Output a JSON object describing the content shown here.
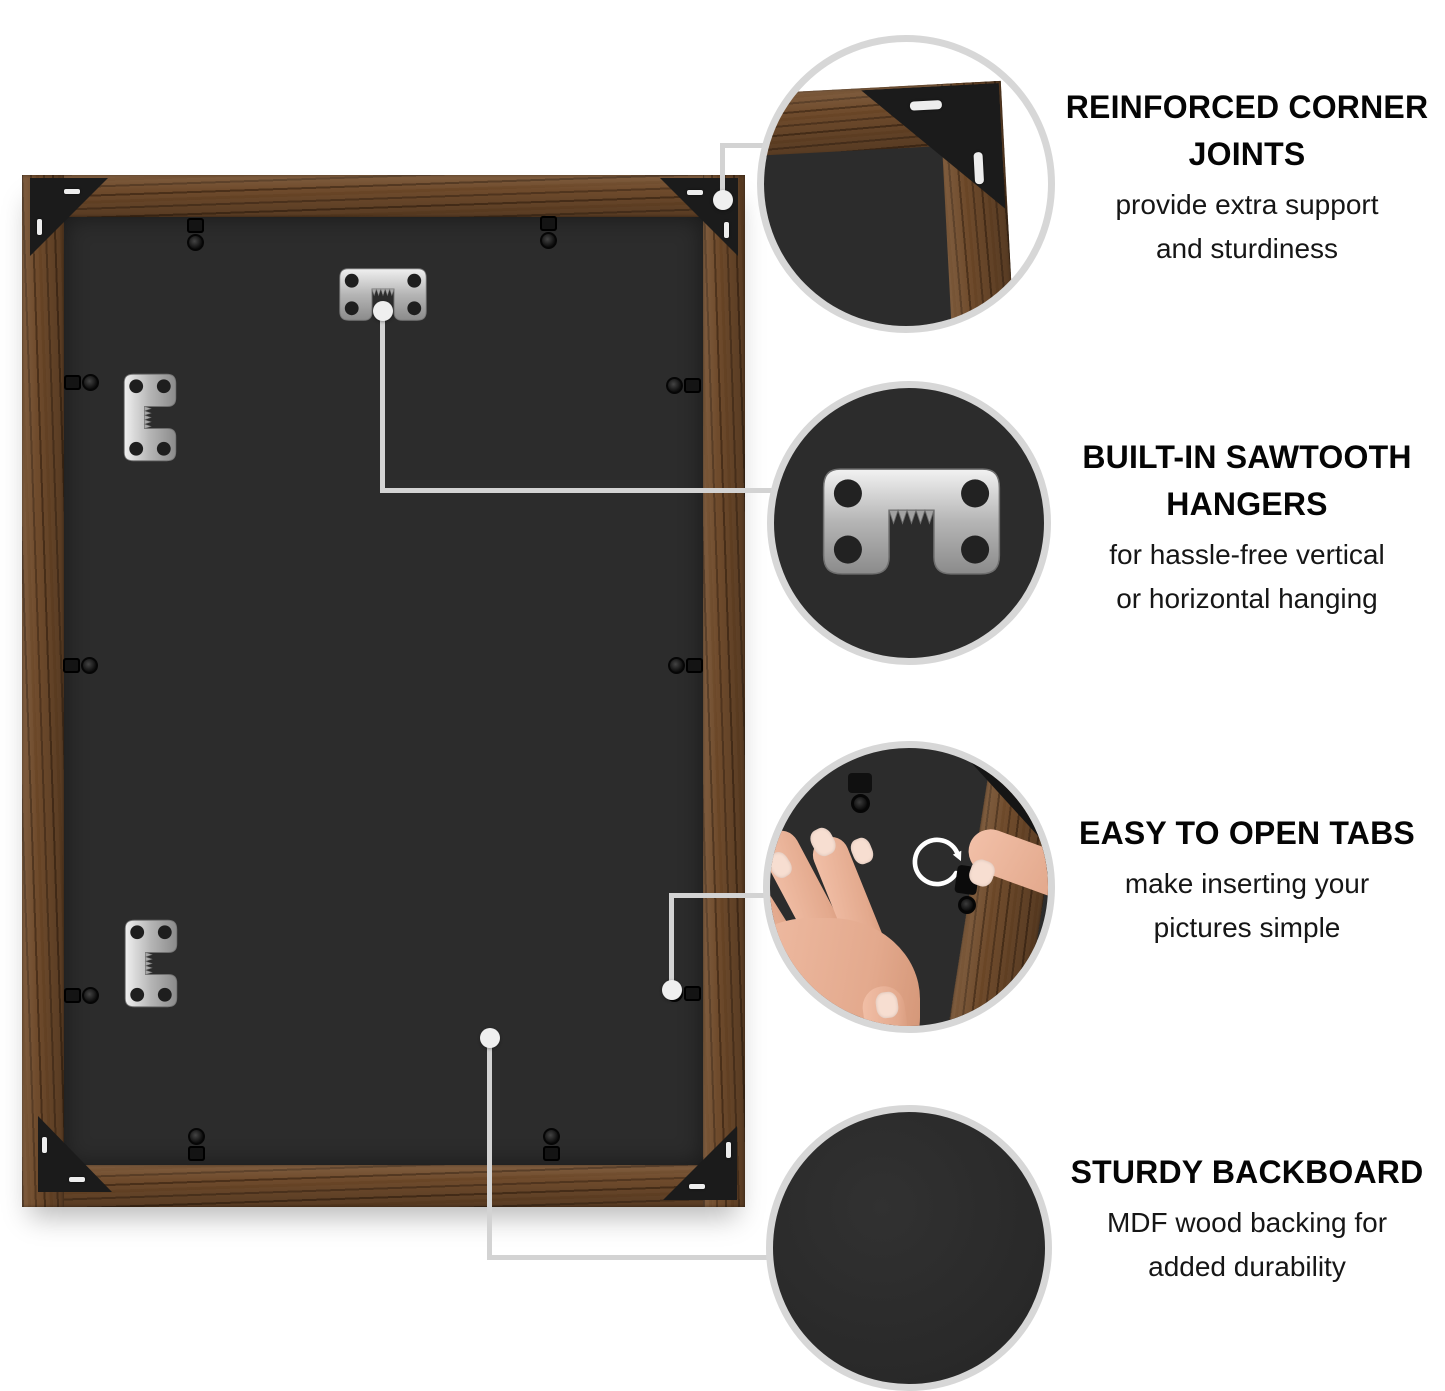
{
  "page_background": "#ffffff",
  "colors": {
    "wood": "#6f4b2c",
    "backboard": "#2c2c2c",
    "bracket": "#1b1b1b",
    "metal_hanger": "#c9c9c9",
    "circle_ring": "#d7d7d7",
    "leader_line": "#d3d3d3",
    "headline_text": "#050505",
    "body_text": "#161616"
  },
  "product": {
    "name": "picture-frame-back",
    "corner_bracket_count": 4,
    "sawtooth_hanger_count": 3,
    "flex_tab_count": 10
  },
  "callouts": [
    {
      "id": "corner-joints",
      "title_lines": [
        "REINFORCED CORNER",
        "JOINTS"
      ],
      "desc_lines": [
        "provide extra support",
        "and sturdiness"
      ]
    },
    {
      "id": "sawtooth-hangers",
      "title_lines": [
        "BUILT-IN SAWTOOTH",
        "HANGERS"
      ],
      "desc_lines": [
        "for hassle-free vertical",
        "or horizontal hanging"
      ]
    },
    {
      "id": "open-tabs",
      "title_lines": [
        "EASY TO OPEN TABS"
      ],
      "desc_lines": [
        "make inserting your",
        "pictures simple"
      ]
    },
    {
      "id": "backboard",
      "title_lines": [
        "STURDY BACKBOARD"
      ],
      "desc_lines": [
        "MDF wood backing for",
        "added durability"
      ]
    }
  ]
}
